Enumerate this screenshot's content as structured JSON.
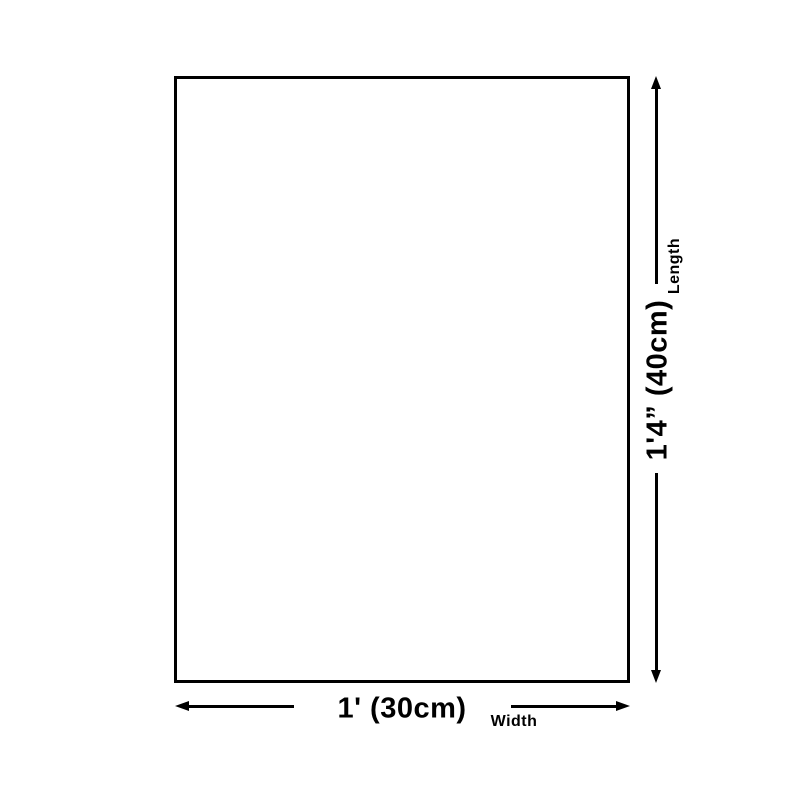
{
  "colors": {
    "ink": "#000000",
    "background": "#ffffff"
  },
  "diagram": {
    "shape": "rectangle",
    "length_dimension": {
      "value": "1'4” (40cm)",
      "axis_label": "Length",
      "arrow_direction": "vertical"
    },
    "width_dimension": {
      "value": "1' (30cm)",
      "axis_label": "Width",
      "arrow_direction": "horizontal"
    }
  }
}
